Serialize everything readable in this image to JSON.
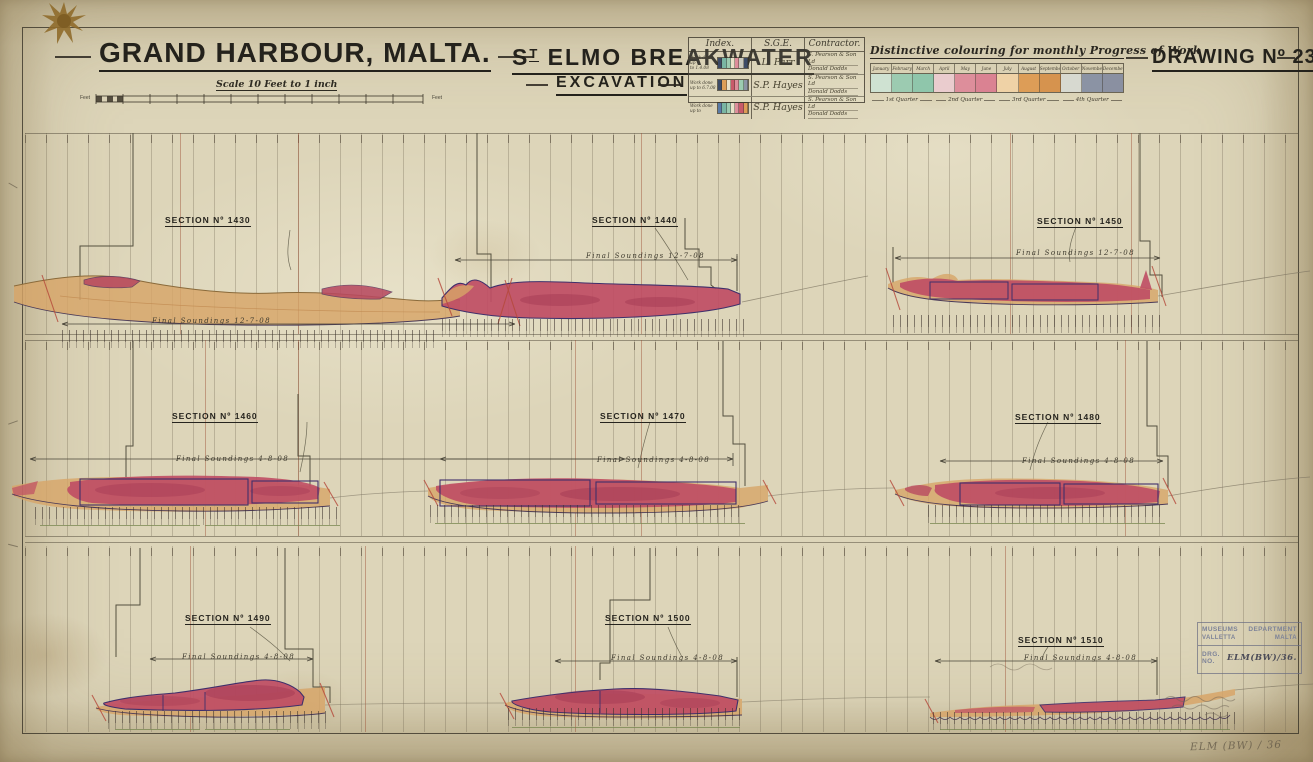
{
  "document": {
    "title_left": "GRAND HARBOUR, MALTA.",
    "title_center_pre": "S",
    "title_center_sup": "T",
    "title_center_rest": " ELMO  BREAKWATER",
    "subtitle": "EXCAVATION",
    "drawing_no": "DRAWING Nº 236",
    "scale_label": "Scale 10 Feet to 1 inch",
    "scale_unit_left": "Feet",
    "scale_unit_right": "Feet"
  },
  "index_table": {
    "col_headers": [
      "Index.",
      "S.G.E.",
      "Contractor."
    ],
    "rows": [
      {
        "label_line1": "Work done up",
        "label_line2": "to 1.4.08",
        "sge": "L. Parr",
        "contractor_line1": "S. Pearson & Son Ld",
        "contractor_line2": "Donald Dodds",
        "swatch": [
          "#3d4b66",
          "#79b5a3",
          "#9ccbb1",
          "#e9e1c9",
          "#dd8e9b",
          "#c9c9bd",
          "#3d4b66"
        ]
      },
      {
        "label_line1": "Work done",
        "label_line2": "up to 6.7.08",
        "sge": "S.P. Hayes",
        "contractor_line1": "S. Pearson & Son Ld",
        "contractor_line2": "Donald Dodds",
        "swatch": [
          "#3d4b66",
          "#dd9d57",
          "#e9e1c9",
          "#c85a6a",
          "#dd8e9b",
          "#9ccbb1",
          "#8b93a4"
        ]
      },
      {
        "label_line1": "Work done",
        "label_line2": "up to",
        "sge": "S.P. Hayes",
        "contractor_line1": "S. Pearson & Son Ld",
        "contractor_line2": "Donald Dodds",
        "swatch": [
          "#5a7ba6",
          "#79b5a3",
          "#9ccbb1",
          "#e9e1c9",
          "#dd8e9b",
          "#c85a6a",
          "#dd9d57"
        ]
      }
    ]
  },
  "progress_legend": {
    "title": "Distinctive colouring for monthly Progress of Work",
    "months": [
      {
        "label": "January",
        "color": "#cfe2d2"
      },
      {
        "label": "February",
        "color": "#9ccbb1"
      },
      {
        "label": "March",
        "color": "#8fc6ab"
      },
      {
        "label": "April",
        "color": "#eaccce"
      },
      {
        "label": "May",
        "color": "#dd8e9b"
      },
      {
        "label": "June",
        "color": "#da8292"
      },
      {
        "label": "July",
        "color": "#efd2a6"
      },
      {
        "label": "August",
        "color": "#dd9d57"
      },
      {
        "label": "September",
        "color": "#d6934e"
      },
      {
        "label": "October",
        "color": "#d7d9d0"
      },
      {
        "label": "November",
        "color": "#8b93a4"
      },
      {
        "label": "December",
        "color": "#8a90a1"
      }
    ],
    "quarters": [
      "1st Quarter",
      "2nd Quarter",
      "3rd Quarter",
      "4th Quarter"
    ]
  },
  "sections": [
    {
      "label": "SECTION Nº 1430",
      "soundings": "Final Soundings 12-7-08"
    },
    {
      "label": "SECTION Nº 1440",
      "soundings": "Final Soundings 12-7-08"
    },
    {
      "label": "SECTION Nº 1450",
      "soundings": "Final Soundings 12-7-08"
    },
    {
      "label": "SECTION Nº 1460",
      "soundings": "Final Soundings 4-8-08"
    },
    {
      "label": "SECTION Nº 1470",
      "soundings": "Final Soundings 4-8-08"
    },
    {
      "label": "SECTION Nº 1480",
      "soundings": "Final Soundings 4-8-08"
    },
    {
      "label": "SECTION Nº 1490",
      "soundings": "Final Soundings 4-8-08"
    },
    {
      "label": "SECTION Nº 1500",
      "soundings": "Final Soundings 4-8-08"
    },
    {
      "label": "SECTION Nº 1510",
      "soundings": "Final Soundings 4-8-08"
    }
  ],
  "stamp": {
    "dept_word1": "MUSEUMS",
    "dept_word2": "DEPARTMENT",
    "city": "VALLETTA",
    "country": "MALTA",
    "drg_label": "DRG. NO.",
    "drg_value": "ELM(BW)/36."
  },
  "annotations": {
    "pencil_note": "ELM (BW) / 36"
  },
  "colors": {
    "paper": "#ddd5b9",
    "ink": "#24221c",
    "excavation_tan": "#d7a568",
    "excavation_crimson": "#bf4d64",
    "outline_purple": "#3f2f6b",
    "dimension_green": "#77854f",
    "stamp_ink": "#7d8398"
  }
}
